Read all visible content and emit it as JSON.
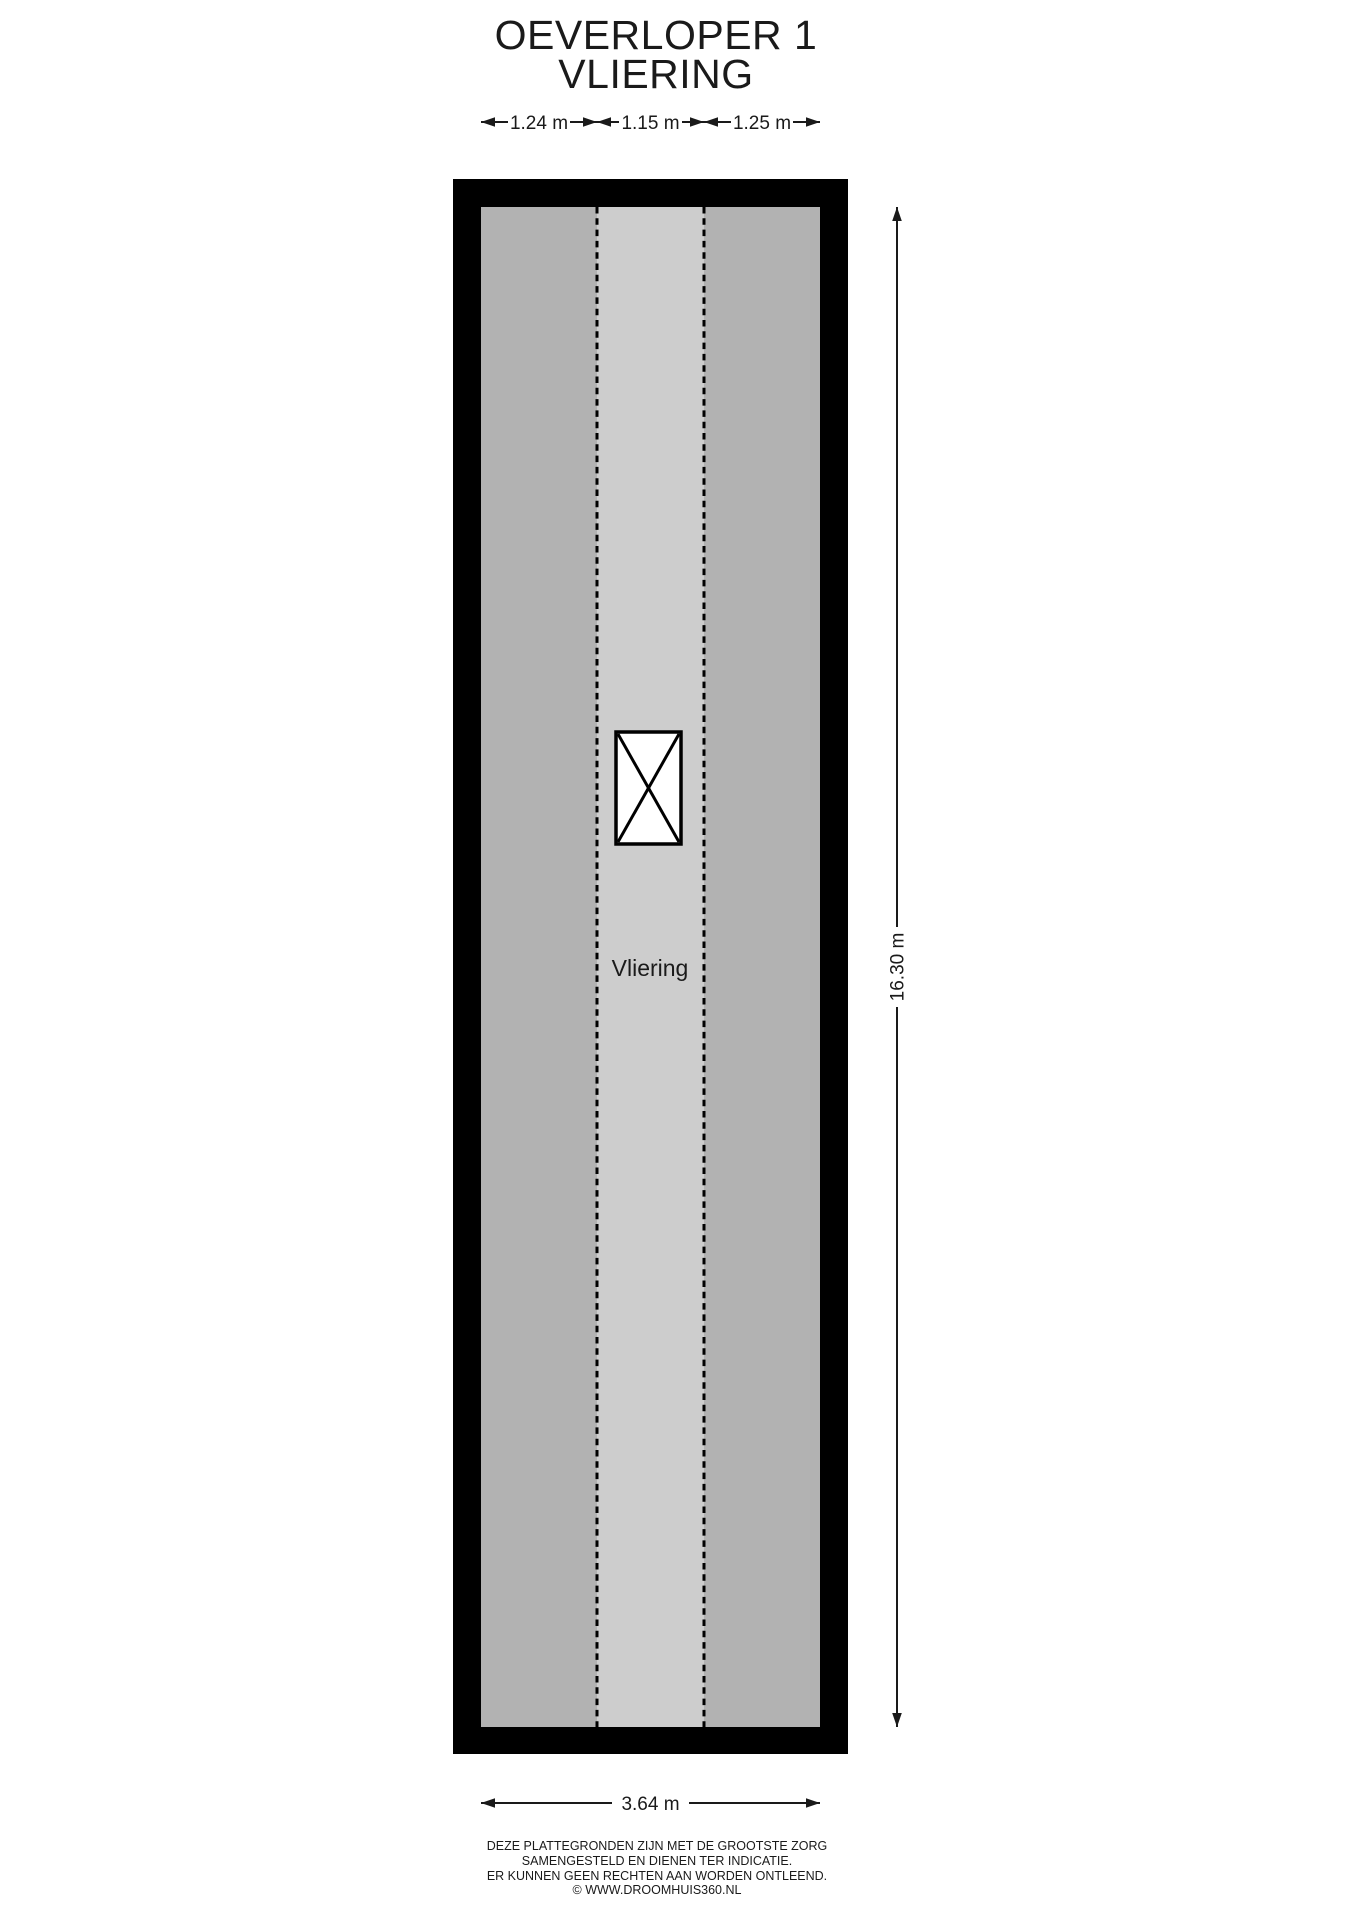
{
  "title": {
    "line1": "OEVERLOPER 1",
    "line2": "VLIERING"
  },
  "room": {
    "label": "Vliering"
  },
  "dimensions": {
    "top": [
      {
        "label": "1.24 m"
      },
      {
        "label": "1.15 m"
      },
      {
        "label": "1.25 m"
      }
    ],
    "right": {
      "label": "16.30 m"
    },
    "bottom": {
      "label": "3.64 m"
    }
  },
  "footer": {
    "lines": [
      "DEZE PLATTEGRONDEN ZIJN MET DE GROOTSTE ZORG",
      "SAMENGESTELD EN DIENEN TER INDICATIE.",
      "ER KUNNEN GEEN RECHTEN AAN WORDEN ONTLEEND.",
      "© WWW.DROOMHUIS360.NL"
    ]
  },
  "colors": {
    "wall": "#000000",
    "floor_side": "#b2b2b2",
    "floor_center": "#cdcdcd",
    "dim": "#1a1a1a",
    "text": "#1a1a1a",
    "stair_fill": "#ffffff"
  }
}
